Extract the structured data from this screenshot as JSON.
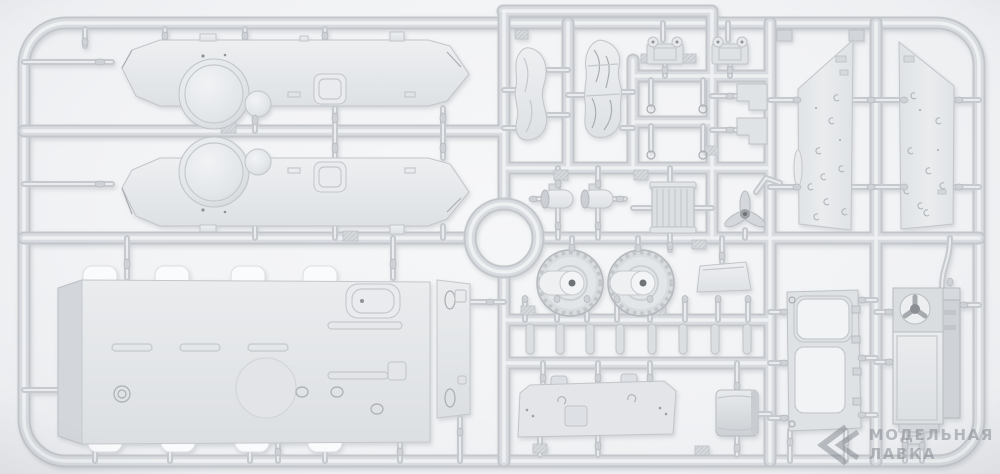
{
  "scene": {
    "type": "photograph",
    "subject": "light-gray injection-molded plastic model kit sprue (parts frame) on a pale background",
    "background_color": "#f2f3f5",
    "sprue_color": "#d6d9dc",
    "part_color": "#e6e8eb",
    "shadow_color": "#b9bdc1"
  },
  "watermark": {
    "line1": "МОДЕЛЬНАЯ",
    "line2": "ЛАВКА",
    "color": "#7f858c",
    "logo": "double-chevron-mark"
  },
  "parts": [
    {
      "id": "hull-side-panel-upper",
      "shape": "long strip with pointed bow tip and round axle bulge below"
    },
    {
      "id": "hull-side-panel-lower",
      "shape": "mirrored long strip with pointed bow tip and round axle bulge above"
    },
    {
      "id": "hull-roof-panel",
      "shape": "large rectangular deck with white fender flaps, slots and oval hatch"
    },
    {
      "id": "narrow-side-plate",
      "shape": "thin plate with teardrop details"
    },
    {
      "id": "rolled-tarpaulin-1",
      "shape": "crumpled roll"
    },
    {
      "id": "rolled-tarpaulin-2",
      "shape": "crumpled roll"
    },
    {
      "id": "bracket-with-ears-1",
      "shape": "small mount bracket"
    },
    {
      "id": "bracket-with-ears-2",
      "shape": "small mount bracket"
    },
    {
      "id": "exhaust-muffler-1",
      "shape": "small cylinder"
    },
    {
      "id": "exhaust-muffler-2",
      "shape": "small cylinder"
    },
    {
      "id": "radiator",
      "shape": "finned rectangle"
    },
    {
      "id": "cooling-fan-propeller",
      "shape": "three-blade fan"
    },
    {
      "id": "sprocket-drum-1",
      "shape": "toothed drum with slotted face"
    },
    {
      "id": "sprocket-drum-2",
      "shape": "toothed drum with slotted face"
    },
    {
      "id": "trapezoid-plate",
      "shape": "small angled plate"
    },
    {
      "id": "pin-row",
      "shape": "rows of small cylindrical pins"
    },
    {
      "id": "engine-deck-plate",
      "shape": "wide flat plate with clamps and hatch"
    },
    {
      "id": "curved-stowage-box",
      "shape": "rounded box"
    },
    {
      "id": "armor-skirt-panel-left",
      "shape": "tall angled panel with clamp marks"
    },
    {
      "id": "armor-skirt-panel-right",
      "shape": "mirrored tall angled panel with clamp marks"
    },
    {
      "id": "hatch-frame",
      "shape": "frame with two rectangular openings"
    },
    {
      "id": "fan-housing-box",
      "shape": "tall box with round fan on top"
    }
  ]
}
